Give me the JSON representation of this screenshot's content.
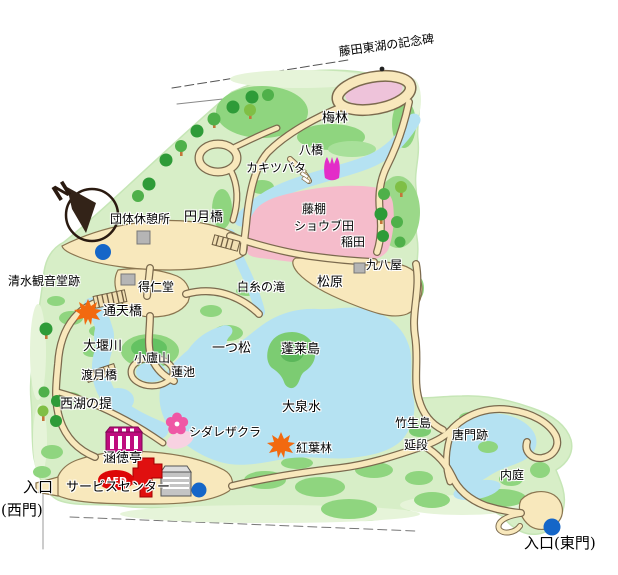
{
  "map": {
    "compass": {
      "letter": "N"
    },
    "aed": {
      "label": "AED"
    },
    "colors": {
      "park_green": "#d7eec7",
      "park_light_green": "#e6f4d9",
      "grass_mid": "#8fd57f",
      "grass_dark": "#5bb75a",
      "tree_green": "#2e9b38",
      "water_blue": "#b5e2f2",
      "path_fill": "#f8e8bc",
      "path_edge": "#7b6a4e",
      "pink_field": "#f5bccb",
      "pink_oval": "#eec3da",
      "sakura_pink": "#ef57a5",
      "tulip_magenta": "#e32cc8",
      "maple_orange": "#f2690f",
      "aed_red": "#dd0707",
      "building_gray": "#b5b5b5",
      "kantokutei_magenta": "#bf0b7e",
      "dot_blue": "#1566c8"
    },
    "icons": [
      {
        "id": "compass-icon"
      },
      {
        "id": "aed-icon"
      },
      {
        "id": "maple-icon"
      },
      {
        "id": "sakura-icon"
      },
      {
        "id": "tulip-icon"
      },
      {
        "id": "bridge-icon"
      },
      {
        "id": "building-icon"
      },
      {
        "id": "water-fountain-dot-icon"
      }
    ],
    "labels": [
      {
        "id": "fujita-toko-monument",
        "text": "藤田東湖の記念碑",
        "x": 338,
        "y": 46,
        "rot": -8
      },
      {
        "id": "bairin",
        "text": "梅林",
        "x": 322,
        "y": 112,
        "cls": "big"
      },
      {
        "id": "yatsuhashi",
        "text": "八橋",
        "x": 299,
        "y": 144
      },
      {
        "id": "kakitsubata",
        "text": "カキツバタ",
        "x": 246,
        "y": 162
      },
      {
        "id": "fujidana",
        "text": "藤棚",
        "x": 302,
        "y": 203
      },
      {
        "id": "shobuda",
        "text": "ショウブ田",
        "x": 294,
        "y": 220
      },
      {
        "id": "inada",
        "text": "稲田",
        "x": 341,
        "y": 236
      },
      {
        "id": "dantai-kyukeijo",
        "text": "団体休憩所",
        "x": 110,
        "y": 213
      },
      {
        "id": "engetsukyo",
        "text": "円月橋",
        "x": 184,
        "y": 211,
        "cls": "big"
      },
      {
        "id": "kuhachiya",
        "text": "九八屋",
        "x": 366,
        "y": 259
      },
      {
        "id": "shimizu-kannondo-ato",
        "text": "清水観音堂跡",
        "x": 8,
        "y": 275
      },
      {
        "id": "tokujindo",
        "text": "得仁堂",
        "x": 138,
        "y": 281
      },
      {
        "id": "shiraito-no-taki",
        "text": "白糸の滝",
        "x": 237,
        "y": 281
      },
      {
        "id": "matsubara",
        "text": "松原",
        "x": 317,
        "y": 276,
        "cls": "big"
      },
      {
        "id": "tsutenkyo",
        "text": "通天橋",
        "x": 103,
        "y": 305,
        "cls": "big"
      },
      {
        "id": "oigawa",
        "text": "大堰川",
        "x": 83,
        "y": 340,
        "cls": "big"
      },
      {
        "id": "shorozan",
        "text": "小廬山",
        "x": 134,
        "y": 352
      },
      {
        "id": "hitotsumatsu",
        "text": "一つ松",
        "x": 212,
        "y": 342,
        "cls": "big"
      },
      {
        "id": "horaijima",
        "text": "蓬莱島",
        "x": 281,
        "y": 343,
        "cls": "big"
      },
      {
        "id": "togetsukyo",
        "text": "渡月橋",
        "x": 81,
        "y": 369
      },
      {
        "id": "hasuike",
        "text": "蓮池",
        "x": 171,
        "y": 366
      },
      {
        "id": "seiko-no-tsutsumi",
        "text": "西湖の提",
        "x": 60,
        "y": 398,
        "cls": "big"
      },
      {
        "id": "daisensui",
        "text": "大泉水",
        "x": 282,
        "y": 401,
        "cls": "big"
      },
      {
        "id": "shidarezakura",
        "text": "シダレザクラ",
        "x": 189,
        "y": 426
      },
      {
        "id": "kantokutei",
        "text": "涵徳亭",
        "x": 103,
        "y": 452,
        "cls": "big"
      },
      {
        "id": "koyorin",
        "text": "紅葉林",
        "x": 296,
        "y": 442
      },
      {
        "id": "chikubushima",
        "text": "竹生島",
        "x": 395,
        "y": 417
      },
      {
        "id": "nobedan",
        "text": "延段",
        "x": 404,
        "y": 439
      },
      {
        "id": "karamon-ato",
        "text": "唐門跡",
        "x": 452,
        "y": 429
      },
      {
        "id": "naitei",
        "text": "内庭",
        "x": 500,
        "y": 469
      },
      {
        "id": "entrance-west-line1",
        "text": "入口",
        "x": 23,
        "y": 479,
        "cls": "serif"
      },
      {
        "id": "entrance-west-line2",
        "text": "(西門)",
        "x": 1,
        "y": 502,
        "cls": "serif"
      },
      {
        "id": "service-center",
        "text": "サービスセンター",
        "x": 66,
        "y": 481,
        "cls": "big"
      },
      {
        "id": "entrance-east",
        "text": "入口(東門)",
        "x": 524,
        "y": 535,
        "cls": "serif"
      }
    ]
  }
}
